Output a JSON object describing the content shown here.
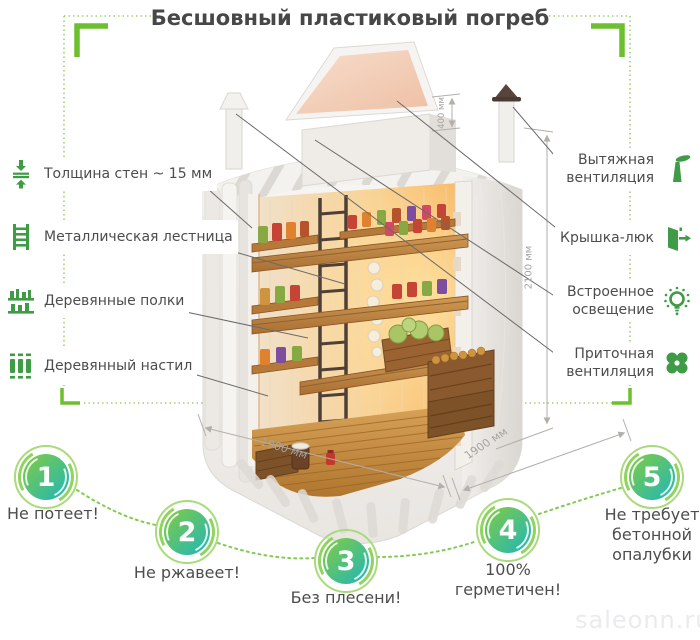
{
  "title": "Бесшовный пластиковый погреб",
  "watermark": "saleonn.ru",
  "left_features": [
    {
      "label": "Толщина стен ~ 15 мм",
      "icon": "wall-thickness-icon"
    },
    {
      "label": "Металлическая лестница",
      "icon": "ladder-icon"
    },
    {
      "label": "Деревянные полки",
      "icon": "shelves-icon"
    },
    {
      "label": "Деревянный настил",
      "icon": "decking-icon"
    }
  ],
  "right_features": [
    {
      "label": "Вытяжная вентиляция",
      "icon": "exhaust-vent-icon"
    },
    {
      "label": "Крышка-люк",
      "icon": "hatch-door-icon"
    },
    {
      "label": "Встроенное освещение",
      "icon": "lighting-icon"
    },
    {
      "label": "Приточная вентиляция",
      "icon": "supply-vent-icon"
    }
  ],
  "dimensions": {
    "hatch_height": "400 мм",
    "body_height": "2100 мм",
    "width": "1900 мм",
    "depth": "1900 мм"
  },
  "benefits": [
    {
      "number": "1",
      "label": "Не потеет!"
    },
    {
      "number": "2",
      "label": "Не ржавеет!"
    },
    {
      "number": "3",
      "label": "Без плесени!"
    },
    {
      "number": "4",
      "label": "100% герметичен!"
    },
    {
      "number": "5",
      "label": "Не требует бетонной опалубки"
    }
  ],
  "colors": {
    "accent_green": "#6cbf2e",
    "icon_green": "#3f9b46",
    "dotted_green": "#9ed174",
    "circle_gradient_start": "#79ca4d",
    "circle_gradient_end": "#2db9a8",
    "text": "#4d4d4d",
    "dimension_text": "#a7a39e",
    "watermark": "#ebebee"
  }
}
